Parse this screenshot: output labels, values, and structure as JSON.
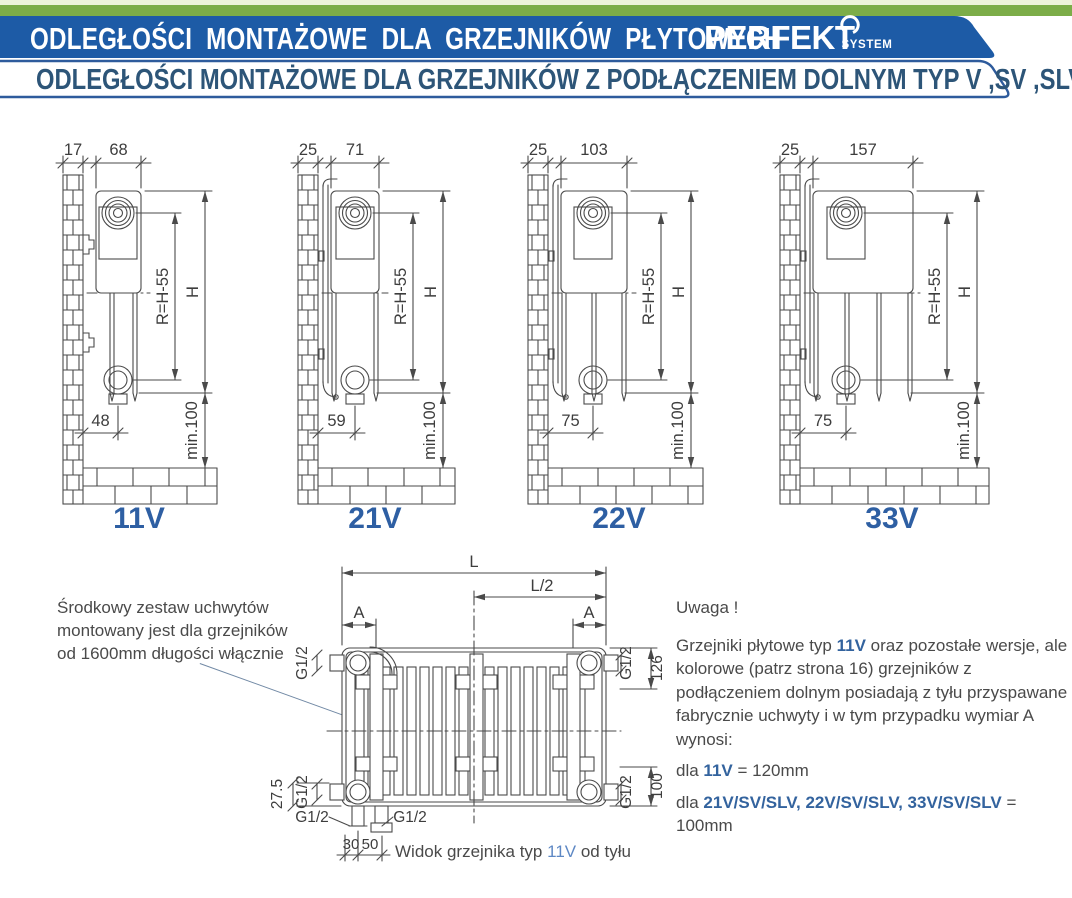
{
  "header": {
    "title": "ODLEGŁOŚCI  MONTAŻOWE  DLA GRZEJNIKÓW  PŁYTOWYCH",
    "brand": "PERFEKT",
    "brand_suffix": "SYSTEM",
    "subtitle": "ODLEGŁOŚCI MONTAŻOWE DLA GRZEJNIKÓW Z PODŁĄCZENIEM DOLNYM TYP V ,SV ,SLV",
    "colors": {
      "strip_pale": "#edf3da",
      "strip_green": "#7cad48",
      "banner_blue": "#1d5ba6",
      "subtitle_text": "#2d5578",
      "subtitle_border": "#2e5b9c"
    }
  },
  "diagrams": [
    {
      "label": "11V",
      "wall_dim": "17",
      "depth_dim": "68",
      "radius_dim": "R=H-55",
      "height_dim": "H",
      "bottom_dim": "48",
      "clearance_dim": "min.100",
      "depth_px": 45,
      "circle_off": 22,
      "panel_xs": [
        16,
        39
      ],
      "mount": "hooks",
      "x": 30,
      "w": 210
    },
    {
      "label": "21V",
      "wall_dim": "25",
      "depth_dim": "71",
      "radius_dim": "R=H-55",
      "height_dim": "H",
      "bottom_dim": "59",
      "clearance_dim": "min.100",
      "depth_px": 48,
      "circle_off": 24,
      "panel_xs": [
        3,
        45
      ],
      "mount": "rail",
      "x": 265,
      "w": 205
    },
    {
      "label": "22V",
      "wall_dim": "25",
      "depth_dim": "103",
      "radius_dim": "R=H-55",
      "height_dim": "H",
      "bottom_dim": "75",
      "clearance_dim": "min.100",
      "depth_px": 66,
      "circle_off": 32,
      "panel_xs": [
        3,
        33,
        63
      ],
      "mount": "rail",
      "x": 495,
      "w": 230
    },
    {
      "label": "33V",
      "wall_dim": "25",
      "depth_dim": "157",
      "radius_dim": "R=H-55",
      "height_dim": "H",
      "bottom_dim": "75",
      "clearance_dim": "min.100",
      "depth_px": 100,
      "circle_off": 33,
      "panel_xs": [
        3,
        34,
        66,
        97
      ],
      "mount": "rail",
      "x": 747,
      "w": 262
    }
  ],
  "rear_view": {
    "dim_l": "L",
    "dim_l2": "L/2",
    "dim_a": "A",
    "dim_g": "G1/2",
    "dim_126": "126",
    "dim_100": "100",
    "dim_275": "27.5",
    "dim_30": "30",
    "dim_50": "50",
    "caption_pre": "Widok grzejnika typ ",
    "caption_type": "11V",
    "caption_post": " od tyłu"
  },
  "notes": {
    "left_note": "Środkowy zestaw uchwytów montowany jest dla grzejników od 1600mm długości włącznie",
    "warning": "Uwaga !",
    "body_pre": "Grzejniki płytowe typ ",
    "body_type": "11V",
    "body_post": " oraz pozostałe wersje, ale kolorowe (patrz strona 16) grzejników z podłączeniem dolnym posiadają z tyłu przyspawane fabrycznie uchwyty i w tym przypadku wymiar A wynosi:",
    "line1_pre": "dla ",
    "line1_type": "11V",
    "line1_post": " = 120mm",
    "line2_pre": "dla ",
    "line2_type": "21V/SV/SLV, 22V/SV/SLV, 33V/SV/SLV",
    "line2_post": " = 100mm"
  },
  "accents": {
    "type_label_blue": "#2e5fa3",
    "note_blue": "#33639e",
    "caption_blue": "#5e88c4",
    "line_color": "#4a4a4a"
  }
}
